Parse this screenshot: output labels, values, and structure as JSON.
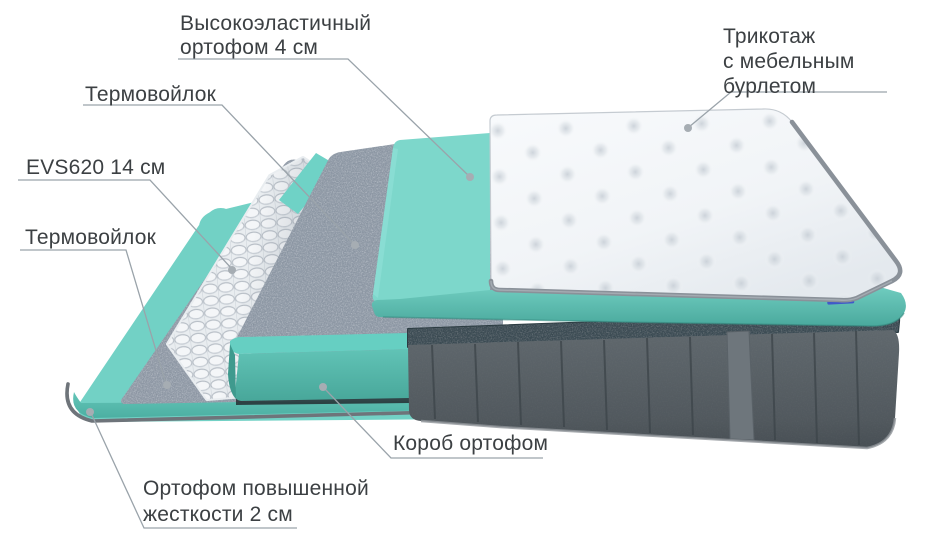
{
  "diagram": {
    "type": "mattress-layer-cutaway",
    "background": "#ffffff"
  },
  "labels": {
    "elastic_foam": {
      "line1": "Высокоэластичный",
      "line2": "ортофом 4 см"
    },
    "thermofelt_top": {
      "line1": "Термовойлок"
    },
    "spring_block": {
      "line1": "EVS620 14 см"
    },
    "thermofelt_bottom": {
      "line1": "Термовойлок"
    },
    "knit_cover": {
      "line1": "Трикотаж",
      "line2": "с мебельным",
      "line3": "бурлетом"
    },
    "foam_box": {
      "line1": "Короб ортофом"
    },
    "rigid_foam": {
      "line1": "Ортофом повышенной",
      "line2": "жесткости 2 см"
    }
  },
  "colors": {
    "text": "#3c4043",
    "leader_line": "#9aa3aa",
    "teal_surface": "#7dd7cb",
    "teal_front": "#57b3a8",
    "felt_gray": "#98a1ad",
    "spring_white": "#f3f5f7",
    "velour_gray": "#525a5f",
    "quilt_white": "#f5f7f9",
    "piping_gray": "#8a9199",
    "tag_blue": "#4059c9"
  }
}
